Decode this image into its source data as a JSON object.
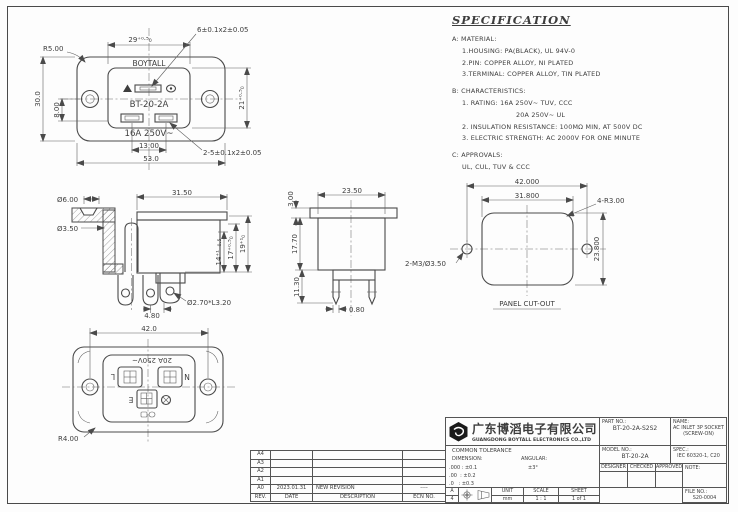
{
  "colors": {
    "line": "#4a4a4a",
    "text": "#3d3d3d",
    "background": "#fdfdfd"
  },
  "spec": {
    "title": "SPECIFICATION",
    "lines": [
      "A: MATERIAL:",
      "1.HOUSING: PA(BLACK), UL 94V-0",
      "2.PIN: COPPER ALLOY, NI PLATED",
      "3.TERMINAL: COPPER ALLOY, TIN PLATED",
      "B: CHARACTERISTICS:",
      "1. RATING: 16A 250V~ TUV, CCC",
      "20A 250V~ UL",
      "2. INSULATION RESISTANCE: 100MΩ MIN, AT 500V DC",
      "3. ELECTRIC STRENGTH: AC 2000V FOR ONE MINUTE",
      "C: APPROVALS:",
      "UL, CUL, TUV & CCC"
    ]
  },
  "front_view": {
    "brand": "BOYTALL",
    "model": "BT-20-2A",
    "rating": "16A 250V~",
    "dims": {
      "corner_radius": "R5.00",
      "face_width": "29⁺⁰·⁵₀",
      "top_slot": "6±0.1x2±0.05",
      "height": "30.0",
      "hole_offset": "8.00",
      "face_height": "21⁺⁰·⁵₀",
      "slot_spacing": "13.00",
      "width": "53.0",
      "bottom_slots": "2-5±0.1x2±0.05"
    }
  },
  "side_view": {
    "dims": {
      "flange_hole_od": "Ø6.00",
      "flange_hole_id": "Ø3.50",
      "body_width": "31.50",
      "depth_14": "14⁺¹₋₀.₅",
      "depth_17": "17⁺⁰·⁵₀",
      "depth_19": "19⁺¹₀",
      "terminal_pitch": "4.80",
      "terminal_hole": "Ø2.70*L3.20"
    }
  },
  "rear_view": {
    "dims": {
      "flange_thickness": "3.00",
      "body_width": "23.50",
      "body_depth": "17.70",
      "pin_length": "11.30",
      "pin_thickness": "0.80"
    }
  },
  "panel_cutout": {
    "caption": "PANEL CUT-OUT",
    "dims": {
      "hole_spacing": "42.000",
      "cutout_width": "31.800",
      "corner_radius": "4-R3.00",
      "cutout_height": "23.800",
      "mounting_holes": "2-M3/Ø3.50"
    }
  },
  "bottom_view": {
    "rating": "20A 250V~",
    "terminal_l": "L",
    "terminal_n": "N",
    "terminal_e": "E",
    "dims": {
      "hole_spacing": "42.0",
      "corner_radius": "R4.00"
    }
  },
  "title_block": {
    "company_cn": "广东博滔电子有限公司",
    "company_en": "GUANGDONG BOYTALL ELECTRONICS CO.,LTD",
    "part_no_label": "PART NO.:",
    "part_no": "BT-20-2A-S2S2",
    "name_label": "NAME:",
    "name_line1": "AC INLET 3P SOCKET",
    "name_line2": "(SCREW-ON)",
    "model_no_label": "MODEL NO.:",
    "model_no": "BT-20-2A",
    "spec_label": "SPEC.:",
    "spec_value": "IEC 60320-1, C20",
    "designer_label": "DESIGNER",
    "checked_label": "CHECKED",
    "approved_label": "APPROVED",
    "note_label": "NOTE:",
    "file_no_label": "FILE NO.:",
    "file_no": "S20-0004",
    "tolerance": {
      "title": "COMMON TOLERANCE",
      "dimension_label": "DIMENSION:",
      "angular_label": "ANGULAR:",
      "row1": ".000 : ±0.1",
      "row2": ".00  : ±0.2",
      "row3": ".0   : ±0.3",
      "angular_value": "±3°"
    },
    "sheet_info": {
      "size_letter": "A",
      "size_number": "4",
      "unit_label": "UNIT",
      "unit_value": "mm",
      "scale_label": "SCALE",
      "scale_value": "1 : 1",
      "sheet_label": "SHEET",
      "sheet_value": "1 of 1"
    }
  },
  "revision_table": {
    "header": [
      "REV.",
      "DATE",
      "DESCRIPTION",
      "ECN NO."
    ],
    "rows": [
      [
        "A4",
        "",
        "",
        ""
      ],
      [
        "A3",
        "",
        "",
        ""
      ],
      [
        "A2",
        "",
        "",
        ""
      ],
      [
        "A1",
        "",
        "",
        ""
      ],
      [
        "A0",
        "2023.01.31",
        "NEW REVISION",
        "----"
      ]
    ]
  }
}
